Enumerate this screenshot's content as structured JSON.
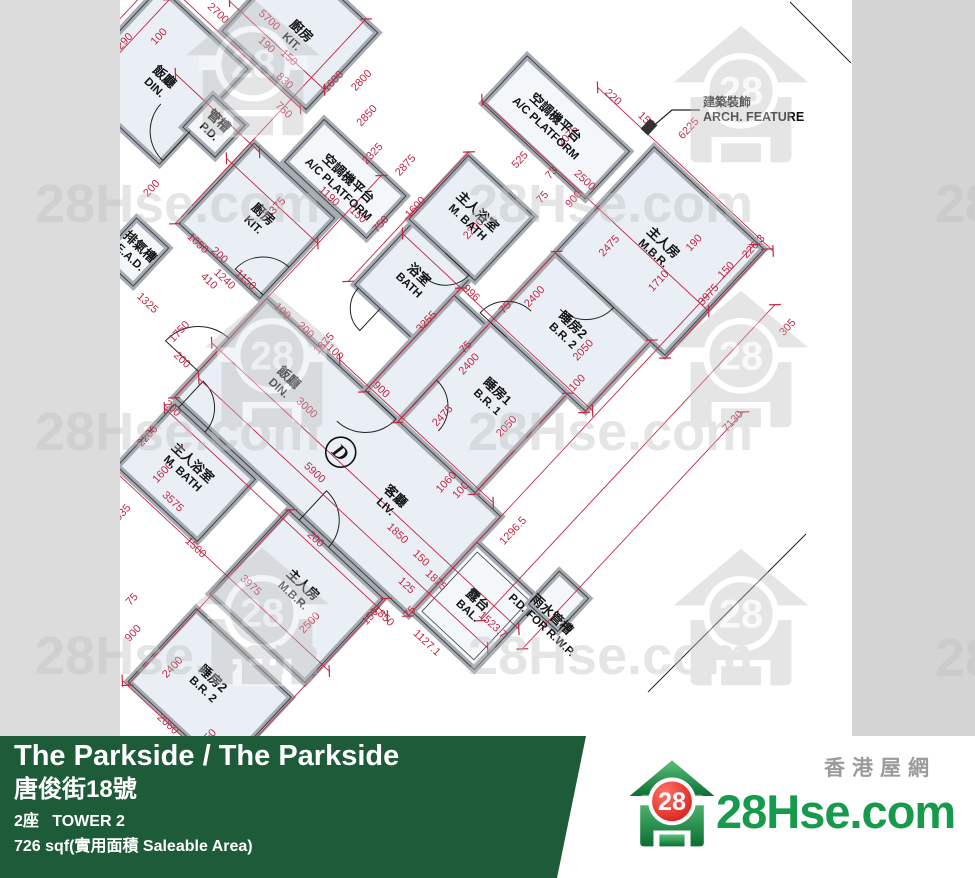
{
  "footer": {
    "title": "The Parkside / The Parkside",
    "address_zh": "唐俊街18號",
    "tower": "2座   TOWER 2",
    "area": "726 sqf(實用面積 Saleable Area)"
  },
  "brand": {
    "name": "28Hse.com",
    "tagline_zh": "香港屋網",
    "logo_number": "28"
  },
  "watermark": {
    "text": "28Hse.com",
    "partial_text": "28",
    "houses": [
      [
        253,
        68
      ],
      [
        741,
        95
      ],
      [
        272,
        360
      ],
      [
        741,
        360
      ],
      [
        262,
        617
      ],
      [
        741,
        618
      ]
    ],
    "texts": [
      [
        35,
        222
      ],
      [
        468,
        222
      ],
      [
        35,
        450
      ],
      [
        468,
        450
      ],
      [
        35,
        674
      ],
      [
        468,
        674
      ]
    ],
    "partials": [
      [
        935,
        222
      ],
      [
        935,
        676
      ]
    ]
  },
  "colors": {
    "bg_left": "#dcdcdc",
    "bg_right": "#d4d4d4",
    "paper": "#ffffff",
    "room": "#e9eff4",
    "room_alt": "#f3f7f9",
    "wall": "#a6abb1",
    "line": "#3c4247",
    "dim": "#c32743",
    "label": "#141414",
    "wm": "#bdbdbd",
    "footer_green": "#1e5c39",
    "brand_green": "#189a4d",
    "brand_gray": "#9b9b9b"
  },
  "plan": {
    "unit_label": "D",
    "rotation_deg": 43,
    "origin": [
      277,
      390
    ],
    "arch_feature": {
      "zh": "建築裝飾",
      "en": "ARCH. FEATURE"
    },
    "rooms": [
      {
        "id": "hall",
        "x": -70,
        "y": -60,
        "w": 320,
        "h": 135,
        "alt": false
      },
      {
        "id": "balcony",
        "x": 250,
        "y": -25,
        "w": 85,
        "h": 95,
        "alt": true,
        "inner": true
      },
      {
        "id": "kitchen",
        "x": -185,
        "y": -165,
        "w": 110,
        "h": 110,
        "alt": false
      },
      {
        "id": "ac-platform-1",
        "x": -150,
        "y": -230,
        "w": 112,
        "h": 58,
        "alt": true
      },
      {
        "id": "ead",
        "x": -220,
        "y": -30,
        "w": 44,
        "h": 52,
        "alt": true
      },
      {
        "id": "bath",
        "x": -15,
        "y": -215,
        "w": 80,
        "h": 85,
        "alt": false
      },
      {
        "id": "master-bath",
        "x": -20,
        "y": -302,
        "w": 90,
        "h": 87,
        "alt": false
      },
      {
        "id": "corridor",
        "x": 65,
        "y": -190,
        "w": 45,
        "h": 130,
        "alt": false
      },
      {
        "id": "bedroom-1",
        "x": 110,
        "y": -195,
        "w": 105,
        "h": 135,
        "alt": false
      },
      {
        "id": "bedroom-2",
        "x": 110,
        "y": -290,
        "w": 130,
        "h": 95,
        "alt": false
      },
      {
        "id": "master-bedroom",
        "x": 110,
        "y": -435,
        "w": 150,
        "h": 145,
        "alt": false
      },
      {
        "id": "ac-platform-2",
        "x": -45,
        "y": -415,
        "w": 140,
        "h": 65,
        "alt": true
      },
      {
        "id": "pd-rwp-box",
        "x": 330,
        "y": -60,
        "w": 40,
        "h": 45,
        "alt": true
      },
      {
        "id": "dining-left",
        "x": -360,
        "y": -215,
        "w": 120,
        "h": 130,
        "alt": false
      },
      {
        "id": "kitchen-left",
        "x": -285,
        "y": -330,
        "w": 115,
        "h": 105,
        "alt": false
      },
      {
        "id": "pd-box",
        "x": -248,
        "y": -172,
        "w": 44,
        "h": 44,
        "alt": true
      },
      {
        "id": "master-bath-left",
        "x": -65,
        "y": 80,
        "w": 110,
        "h": 85,
        "alt": false
      },
      {
        "id": "master-bedroom-left",
        "x": 90,
        "y": 80,
        "w": 130,
        "h": 115,
        "alt": false
      },
      {
        "id": "bedroom-2-left",
        "x": 90,
        "y": 215,
        "w": 130,
        "h": 100,
        "alt": false
      }
    ],
    "labels": [
      {
        "zh": "飯廳",
        "en": "DIN.",
        "x": -296,
        "y": -145
      },
      {
        "zh": "廚房",
        "en": "KIT.",
        "x": -227,
        "y": -272
      },
      {
        "zh": "管槽",
        "en": "P.D.",
        "x": -226,
        "y": -150
      },
      {
        "zh": "排氣槽",
        "en": "E.A.D.",
        "x": -198,
        "y": -4
      },
      {
        "zh": "廚房",
        "en": "KIT.",
        "x": -130,
        "y": -112
      },
      {
        "zh": "空調機平台",
        "en": "A/C PLATFORM",
        "x": -92,
        "y": -196
      },
      {
        "zh": "飯廳",
        "en": "DIN.",
        "x": 0,
        "y": -10
      },
      {
        "zh": "客廳",
        "en": "LIV.",
        "x": 159,
        "y": 4
      },
      {
        "zh": "露台",
        "en": "BAL.",
        "x": 290,
        "y": 24
      },
      {
        "zh": "浴室",
        "en": "BATH",
        "x": 25,
        "y": -174
      },
      {
        "zh": "主人浴室",
        "en": "M. BATH",
        "x": 25,
        "y": -260
      },
      {
        "zh": "睡房1",
        "en": "B.R. 1",
        "x": 162,
        "y": -142
      },
      {
        "zh": "睡房2",
        "en": "B.R. 2",
        "x": 172,
        "y": -242
      },
      {
        "zh": "主人房",
        "en": "M.B.R.",
        "x": 182,
        "y": -364
      },
      {
        "zh": "空調機平台",
        "en": "A/C PLATFORM",
        "x": 18,
        "y": -382
      },
      {
        "zh": "雨水管槽",
        "en": "P.D. FOR R.W.P.",
        "x": 354,
        "y": -16
      },
      {
        "zh": "主人浴室",
        "en": "M. BATH",
        "x": -12,
        "y": 118
      },
      {
        "zh": "主人房",
        "en": "M.B.R.",
        "x": 152,
        "y": 132
      },
      {
        "zh": "睡房2",
        "en": "B.R. 2",
        "x": 150,
        "y": 262
      }
    ],
    "dims": [
      [
        "2700",
        -300,
        -232,
        "h"
      ],
      [
        "5700",
        -258,
        -262,
        "h"
      ],
      [
        "150",
        -218,
        -248,
        "h"
      ],
      [
        "1600",
        -370,
        -150,
        "v"
      ],
      [
        "1290",
        -346,
        -148,
        "v"
      ],
      [
        "100",
        -324,
        -178,
        "v"
      ],
      [
        "200",
        -374,
        -88,
        "v"
      ],
      [
        "190",
        -243,
        -242,
        "h"
      ],
      [
        "830",
        -205,
        -228,
        "h"
      ],
      [
        "1600",
        -166,
        -264,
        "v"
      ],
      [
        "2800",
        -146,
        -284,
        "v"
      ],
      [
        "750",
        -186,
        -206,
        "h"
      ],
      [
        "2850",
        -118,
        -262,
        "v"
      ],
      [
        "2325",
        -88,
        -238,
        "v"
      ],
      [
        "2875",
        -56,
        -252,
        "v"
      ],
      [
        "3375",
        -122,
        -132,
        "v"
      ],
      [
        "1050",
        -158,
        -50,
        "h"
      ],
      [
        "200",
        -134,
        -56,
        "h"
      ],
      [
        "1190",
        -94,
        -174,
        "h"
      ],
      [
        "150",
        -60,
        -180,
        "h"
      ],
      [
        "750",
        -34,
        -192,
        "v"
      ],
      [
        "1100",
        14,
        -64,
        "h"
      ],
      [
        "1750",
        -108,
        24,
        "v"
      ],
      [
        "200",
        -90,
        46,
        "h"
      ],
      [
        "1325",
        -154,
        28,
        "h"
      ],
      [
        "410",
        -124,
        -30,
        "h"
      ],
      [
        "1150",
        -98,
        -56,
        "h"
      ],
      [
        "1240",
        -114,
        -42,
        "h"
      ],
      [
        "900",
        76,
        -68,
        "h"
      ],
      [
        "3000",
        34,
        -4,
        "h"
      ],
      [
        "5900",
        84,
        38,
        "h"
      ],
      [
        "1850",
        186,
        26,
        "h"
      ],
      [
        "1875",
        246,
        34,
        "h"
      ],
      [
        "150",
        220,
        28,
        "h"
      ],
      [
        "125",
        228,
        58,
        "h"
      ],
      [
        "75",
        252,
        72,
        "v"
      ],
      [
        "1127.1",
        282,
        86,
        "h"
      ],
      [
        "1523.7",
        318,
        28,
        "h"
      ],
      [
        "1296.5",
        272,
        -58,
        "v"
      ],
      [
        "2475",
        142,
        -94,
        "v"
      ],
      [
        "2400",
        126,
        -150,
        "v"
      ],
      [
        "2050",
        196,
        -130,
        "v"
      ],
      [
        "75",
        112,
        -160,
        "v"
      ],
      [
        "1060",
        190,
        -48,
        "v"
      ],
      [
        "100",
        206,
        -52,
        "v"
      ],
      [
        "3255",
        66,
        -152,
        "v"
      ],
      [
        "1875",
        6,
        -66,
        "v"
      ],
      [
        "996",
        76,
        -200,
        "h"
      ],
      [
        "2400",
        128,
        -244,
        "v"
      ],
      [
        "2050",
        200,
        -238,
        "v"
      ],
      [
        "75",
        114,
        -216,
        "v"
      ],
      [
        "100",
        218,
        -210,
        "v"
      ],
      [
        "2200",
        37,
        -252,
        "v"
      ],
      [
        "1600",
        -20,
        -228,
        "v"
      ],
      [
        "525",
        24,
        -334,
        "v"
      ],
      [
        "900",
        90,
        -342,
        "v"
      ],
      [
        "75",
        66,
        -322,
        "v"
      ],
      [
        "73",
        56,
        -346,
        "v"
      ],
      [
        "2500",
        82,
        -360,
        "h"
      ],
      [
        "2075",
        43,
        -384,
        "v"
      ],
      [
        "220",
        46,
        -440,
        "h"
      ],
      [
        "150",
        86,
        -446,
        "h"
      ],
      [
        "3975",
        254,
        -364,
        "v"
      ],
      [
        "2475",
        148,
        -332,
        "v"
      ],
      [
        "1710",
        208,
        -340,
        "v"
      ],
      [
        "190",
        208,
        -392,
        "v"
      ],
      [
        "150",
        250,
        -394,
        "v"
      ],
      [
        "6225",
        126,
        -472,
        "v"
      ],
      [
        "226.3",
        254,
        -430,
        "v"
      ],
      [
        "7130",
        358,
        -288,
        "v"
      ],
      [
        "305",
        334,
        -394,
        "v"
      ],
      [
        "2200",
        -60,
        122,
        "v"
      ],
      [
        "1600",
        -24,
        138,
        "v"
      ],
      [
        "3575",
        0,
        156,
        "h"
      ],
      [
        "200",
        -64,
        88,
        "h"
      ],
      [
        "1500",
        48,
        174,
        "h"
      ],
      [
        "1035",
        -26,
        198,
        "v"
      ],
      [
        "900",
        64,
        276,
        "v"
      ],
      [
        "75",
        40,
        252,
        "v"
      ],
      [
        "2400",
        116,
        274,
        "v"
      ],
      [
        "2050",
        190,
        304,
        "v"
      ],
      [
        "2500",
        186,
        148,
        "v"
      ],
      [
        "3975",
        114,
        164,
        "h"
      ],
      [
        "2060",
        148,
        322,
        "h"
      ],
      [
        "1850",
        232,
        96,
        "h"
      ],
      [
        "200",
        130,
        86,
        "h"
      ],
      [
        "150",
        226,
        102,
        "v"
      ],
      [
        "200",
        -20,
        -60,
        "h"
      ],
      [
        "100",
        -50,
        -58,
        "h"
      ],
      [
        "1600",
        -212,
        40,
        "v"
      ],
      [
        "200",
        -226,
        -62,
        "v"
      ]
    ],
    "dim_lines": [
      [
        -360,
        -222,
        -175,
        -222
      ],
      [
        -300,
        -252,
        -170,
        -252
      ],
      [
        -80,
        10,
        340,
        10
      ],
      [
        -65,
        45,
        330,
        45
      ],
      [
        25,
        -65,
        235,
        -65
      ],
      [
        -15,
        -200,
        245,
        -200
      ],
      [
        -48,
        -352,
        262,
        -352
      ],
      [
        28,
        -440,
        268,
        -440
      ],
      [
        -70,
        170,
        230,
        170
      ],
      [
        -70,
        90,
        235,
        90
      ],
      [
        85,
        318,
        225,
        318
      ],
      [
        -195,
        -135,
        -70,
        -135
      ],
      [
        -290,
        -162,
        -175,
        -162
      ],
      [
        -368,
        -215,
        -368,
        -80
      ],
      [
        -345,
        -212,
        -345,
        -82
      ],
      [
        250,
        -432,
        250,
        76
      ],
      [
        306,
        -402,
        306,
        30
      ],
      [
        356,
        -302,
        356,
        22
      ],
      [
        -70,
        -228,
        -70,
        76
      ],
      [
        65,
        -200,
        65,
        -58
      ],
      [
        110,
        -292,
        110,
        -58
      ],
      [
        240,
        -292,
        240,
        -193
      ],
      [
        262,
        -437,
        262,
        -288
      ],
      [
        -188,
        -332,
        -188,
        -52
      ],
      [
        215,
        -196,
        215,
        -58
      ],
      [
        -22,
        -305,
        -22,
        -128
      ],
      [
        92,
        78,
        92,
        318
      ],
      [
        222,
        78,
        222,
        320
      ]
    ],
    "doors": [
      {
        "cx": -70,
        "cy": 40,
        "r": 45,
        "a0": 180,
        "a1": 270
      },
      {
        "cx": -75,
        "cy": -60,
        "r": 38,
        "a0": 180,
        "a1": 270
      },
      {
        "cx": 65,
        "cy": -60,
        "r": 42,
        "a0": 0,
        "a1": 90
      },
      {
        "cx": 20,
        "cy": -130,
        "r": 30,
        "a0": 90,
        "a1": 180
      },
      {
        "cx": 30,
        "cy": -215,
        "r": 32,
        "a0": 0,
        "a1": 90
      },
      {
        "cx": 110,
        "cy": -80,
        "r": 36,
        "a0": 270,
        "a1": 360
      },
      {
        "cx": 132,
        "cy": -195,
        "r": 36,
        "a0": 180,
        "a1": 270
      },
      {
        "cx": 152,
        "cy": -290,
        "r": 38,
        "a0": 0,
        "a1": 90
      },
      {
        "cx": 105,
        "cy": 80,
        "r": 40,
        "a0": 270,
        "a1": 360
      },
      {
        "cx": -60,
        "cy": 80,
        "r": 36,
        "a0": 270,
        "a1": 360
      },
      {
        "cx": -240,
        "cy": -130,
        "r": 40,
        "a0": 90,
        "a1": 180
      }
    ]
  }
}
